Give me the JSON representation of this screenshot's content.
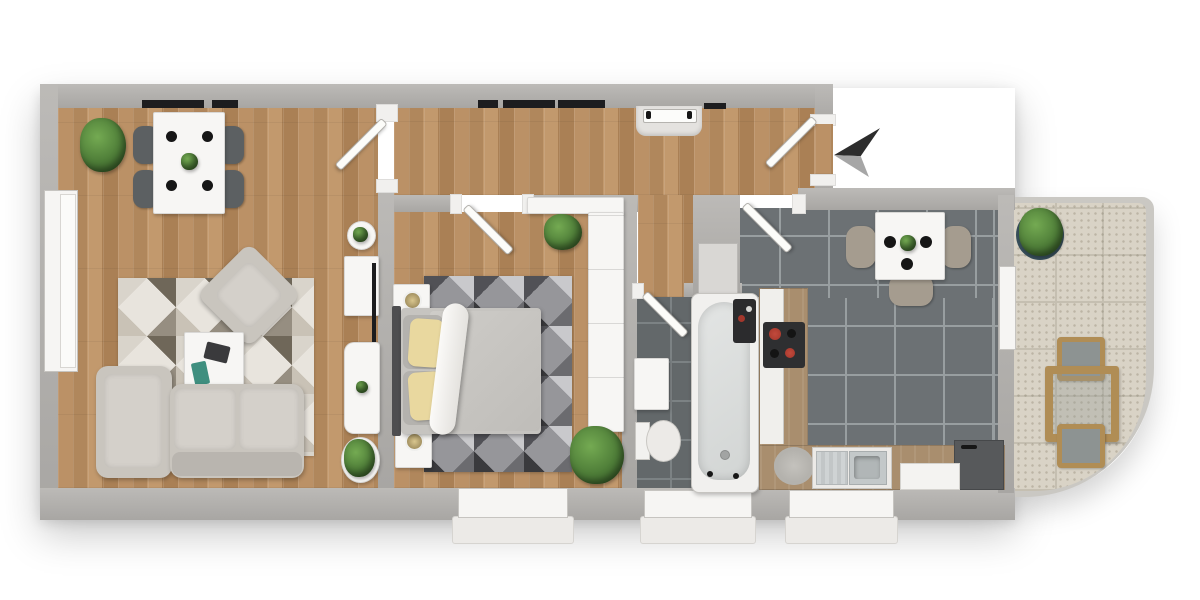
{
  "meta": {
    "kind": "3d-rendered floor plan, top-down view",
    "text_on_screen": "none"
  },
  "colors": {
    "wall": "#a8a6a3",
    "wall_hi": "#bcbab7",
    "wood": "#b78c60",
    "tile_bath": "#63686a",
    "tile_kitchen": "#6c7174",
    "balcony_tile": "#d9d3c6",
    "furn_white": "#f7f6f4",
    "window_white": "#f6f5f3",
    "glazing": "#1d1d1f",
    "sofa": "#c9c5be",
    "chair_dark": "#5c6062",
    "chair_taupe": "#a59c8f",
    "counter_wood": "#a98e6e",
    "plant": "#4e7d38",
    "pillow_yellow": "#e9d89f",
    "headboard": "#4e4e50",
    "hob_black": "#2e2f31",
    "hob_red": "#a5362b",
    "tv_black": "#1c1c1e",
    "arrow_dark": "#2d2d2d",
    "arrow_light": "#a6a6a6",
    "caddy_dark": "#2b2b2d",
    "appliance_dark": "#57595b",
    "sink_steel": "#c3c8c9"
  },
  "compass": {
    "arrow_points": "left"
  },
  "rooms": [
    {
      "id": "living-room",
      "floor": "wood plank",
      "items": [
        "corner-plant",
        "dining-table-white",
        "four-dark-chairs",
        "four-black-plates",
        "table-plant",
        "rotated-armchair",
        "geometric-triangle-rug",
        "coffee-table",
        "magazine",
        "teal-book",
        "l-shaped-sofa",
        "round-side-table",
        "tv-sideboard",
        "wall-tv",
        "lounge-chair",
        "floor-plant"
      ]
    },
    {
      "id": "hallway",
      "floor": "wood plank",
      "items": [
        "entrance-niche-door",
        "open-entrance-door-leaf",
        "built-in-closet"
      ]
    },
    {
      "id": "bedroom",
      "floor": "wood plank",
      "items": [
        "double-bed",
        "dark-headboard",
        "two-yellow-pillows",
        "white-blanket-roll",
        "two-nightstands-with-lamps",
        "dark-geometric-rug",
        "tall-wardrobe",
        "top-shelf",
        "plant-north",
        "plant-south"
      ]
    },
    {
      "id": "bathroom",
      "floor": "dark tile",
      "items": [
        "bathtub",
        "toilet",
        "vanity-cabinet",
        "dark-shelf-caddy"
      ]
    },
    {
      "id": "kitchen",
      "floor": "dark tile",
      "items": [
        "square-dining-table",
        "three-taupe-chairs",
        "three-black-plates",
        "table-plant",
        "left-counter-with-hob",
        "bottom-counter-with-sink",
        "round-gray-rug",
        "dark-appliance",
        "white-appliance-front"
      ]
    },
    {
      "id": "balcony",
      "floor": "light speckled tile, curved corner",
      "items": [
        "potted-plant",
        "wooden-outdoor-table",
        "two-outdoor-chairs"
      ]
    }
  ],
  "openings": {
    "doors": [
      "living-room-door",
      "bedroom-door",
      "bathroom-door",
      "kitchen-door",
      "entrance-door",
      "balcony-door",
      "niche-door"
    ],
    "windows": [
      "top-wall-window-living",
      "top-wall-window-hall",
      "left-wall-window",
      "bedroom-south-window",
      "bathroom-south-window",
      "kitchen-south-window"
    ]
  }
}
